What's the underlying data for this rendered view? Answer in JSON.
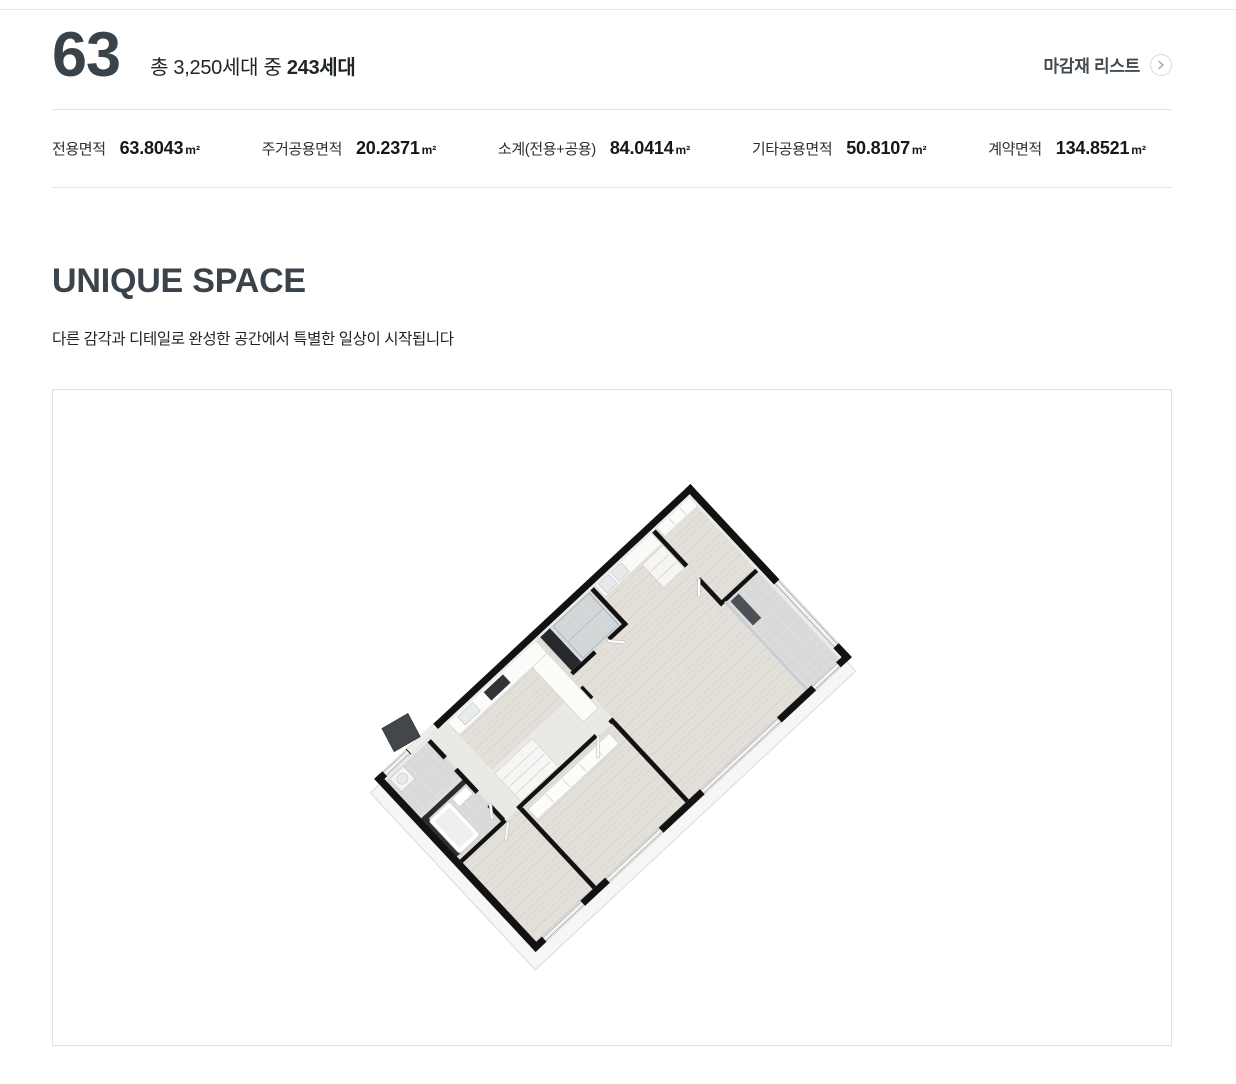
{
  "theme": {
    "divider_color": "#e4e4e4",
    "panel_border_color": "#e1e1e1",
    "heading_color": "#3a424a",
    "text_color": "#1f2428",
    "wall_color": "#121212",
    "wood_floor_color": "#e3e0da",
    "tile_floor_color": "#d9d9d9",
    "entry_door_color": "#43474a"
  },
  "header": {
    "unit_type": "63",
    "supply_prefix": "총 3,250세대 중 ",
    "supply_strong": "243세대",
    "finish_link_label": "마감재 리스트",
    "finish_link_icon": "chevron-right-circle-icon"
  },
  "area_stats": {
    "items": [
      {
        "label": "전용면적",
        "value": "63.8043",
        "unit": "m²"
      },
      {
        "label": "주거공용면적",
        "value": "20.2371",
        "unit": "m²"
      },
      {
        "label": "소계(전용+공용)",
        "value": "84.0414",
        "unit": "m²"
      },
      {
        "label": "기타공용면적",
        "value": "50.8107",
        "unit": "m²"
      },
      {
        "label": "계약면적",
        "value": "134.8521",
        "unit": "m²"
      }
    ]
  },
  "unique_space": {
    "title": "UNIQUE SPACE",
    "subtitle": "다른 감각과 디테일로 완성한 공간에서 특별한 일상이 시작됩니다"
  },
  "floorplan": {
    "type": "3d-isometric-floor-plan",
    "unit": "63"
  }
}
